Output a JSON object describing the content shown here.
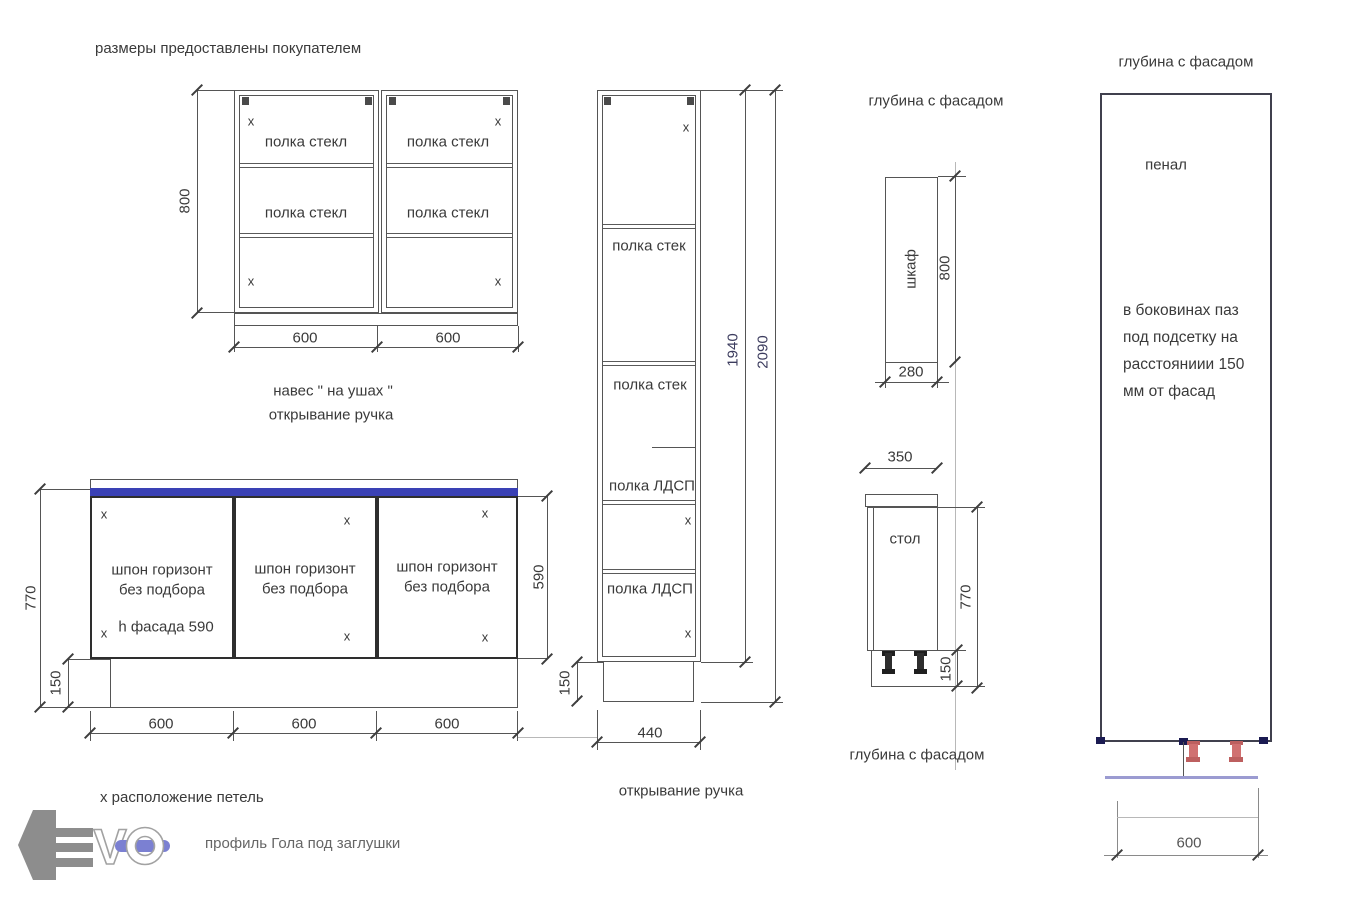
{
  "colors": {
    "line": "#555555",
    "text": "#3a3a3a",
    "countertop_blue": "#3a41b5",
    "leg_red": "#d07070",
    "floor_lavender": "#9b9bd1",
    "corner_navy": "#1b1b52",
    "logo_gray": "#8d8d8d",
    "logo_bar_blue": "#7b80d2"
  },
  "notes": {
    "customer_sizes": "размеры предоставлены покупателем",
    "hinge_note": "х расположение петель",
    "gola_note": "профиль Гола под заглушки"
  },
  "marks": {
    "x": "х"
  },
  "wall_cabinet": {
    "shelf_label": "полка стекл",
    "dim_height": "800",
    "dim_width_left": "600",
    "dim_width_right": "600",
    "caption_line1": "навес \" на ушах \"",
    "caption_line2": "открывание ручка"
  },
  "base_cabinet": {
    "door_line1": "шпон горизонт",
    "door_line2": "без подбора",
    "door1_note": "h фасада 590",
    "dim_height": "770",
    "dim_plinth": "150",
    "dim_facade_height": "590",
    "dim_w1": "600",
    "dim_w2": "600",
    "dim_w3": "600"
  },
  "tall_cabinet": {
    "shelf_glass": "полка стек",
    "shelf_ldsp": "полка ЛДСП",
    "dim_inner_height": "1940",
    "dim_total_height": "2090",
    "dim_plinth": "150",
    "dim_width": "440",
    "caption": "открывание ручка"
  },
  "depth_views": {
    "header": "глубина с фасадом",
    "footer": "глубина с фасадом",
    "wall_unit_label": "шкаф",
    "wall_unit_height": "800",
    "wall_unit_depth": "280",
    "base_unit_label": "стол",
    "base_unit_depth": "350",
    "base_unit_height": "770",
    "base_unit_plinth": "150"
  },
  "penal": {
    "header": "глубина с фасадом",
    "label": "пенал",
    "note_line1": "в боковинах паз",
    "note_line2": "под подсетку  на",
    "note_line3": "расстояниии 150",
    "note_line4": "мм от фасад",
    "dim_width": "600"
  },
  "logo": {
    "letter_v": "V",
    "letter_o": "O"
  }
}
